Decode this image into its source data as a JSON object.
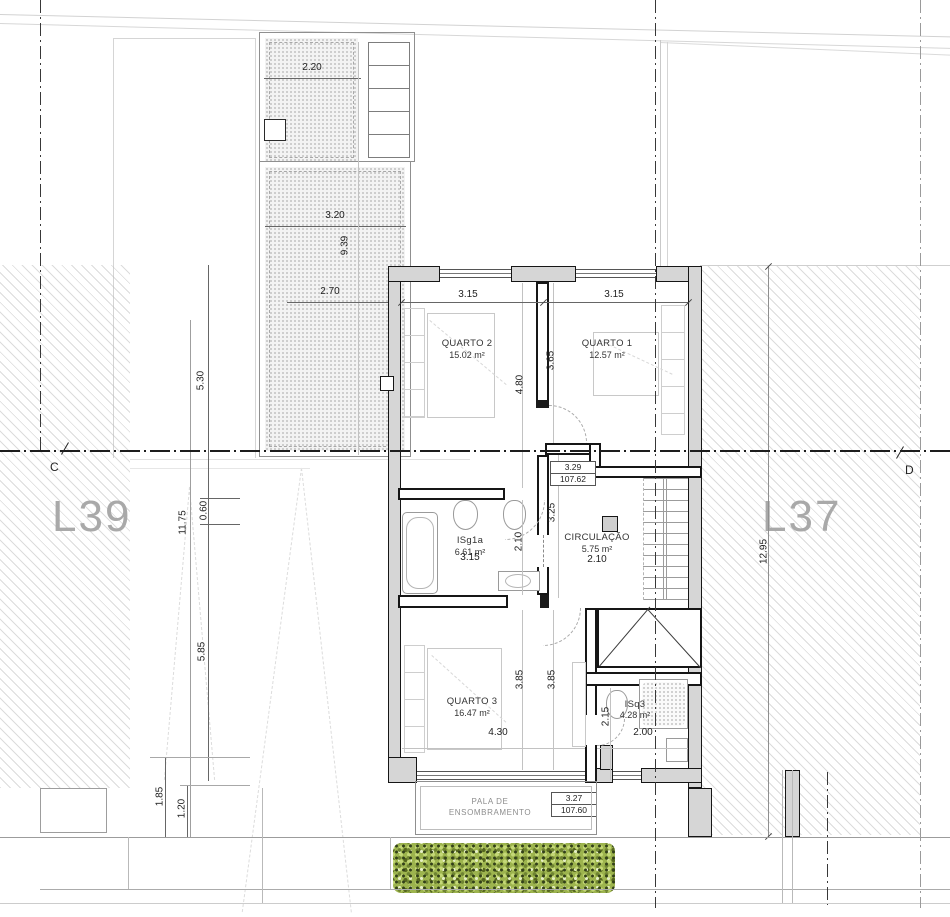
{
  "plan": {
    "lots": {
      "left": "L39",
      "right": "L37"
    },
    "section": {
      "left_marker": "C",
      "right_marker": "D"
    },
    "rooms": {
      "quarto2": {
        "name": "QUARTO 2",
        "area": "15.02 m²"
      },
      "quarto1": {
        "name": "QUARTO 1",
        "area": "12.57 m²"
      },
      "isg1a": {
        "name": "ISg1a",
        "area": "6.61 m²"
      },
      "circulacao": {
        "name": "CIRCULAÇÃO",
        "area": "5.75 m²"
      },
      "quarto3": {
        "name": "QUARTO 3",
        "area": "16.47 m²"
      },
      "isq3": {
        "name": "ISq3",
        "area": "4.28 m²"
      }
    },
    "canopy": {
      "line1": "PALA DE",
      "line2": "ENSOMBRAMENTO"
    },
    "levels": {
      "upper": {
        "height": "3.29",
        "elevation": "107.62"
      },
      "lower": {
        "height": "3.27",
        "elevation": "107.60"
      }
    },
    "dims": {
      "patio_top": "2.20",
      "patio_mid": "3.20",
      "patio_vert": "9.39",
      "patio_low": "2.70",
      "q2_top": "3.15",
      "q1_top": "3.15",
      "q1_side": "3.65",
      "q2_side": "4.80",
      "left_upper": "5.30",
      "left_total": "11.75",
      "left_offset": "0.60",
      "left_lower": "5.85",
      "bottom_a": "1.85",
      "bottom_b": "1.20",
      "stair_side": "3.25",
      "bath_side": "2.10",
      "bath_width": "3.15",
      "circ_width": "2.10",
      "q3_side_a": "3.85",
      "q3_side_b": "3.85",
      "q3_width": "4.30",
      "isq3_side": "2.15",
      "isq3_width": "2.00",
      "right_total": "12.95"
    },
    "colors": {
      "wall_fill": "#d6d6d6",
      "wall_line": "#161616",
      "lot_label": "#a9a9a9",
      "hedge_green": "#9db44e",
      "axis": "#383838"
    }
  }
}
